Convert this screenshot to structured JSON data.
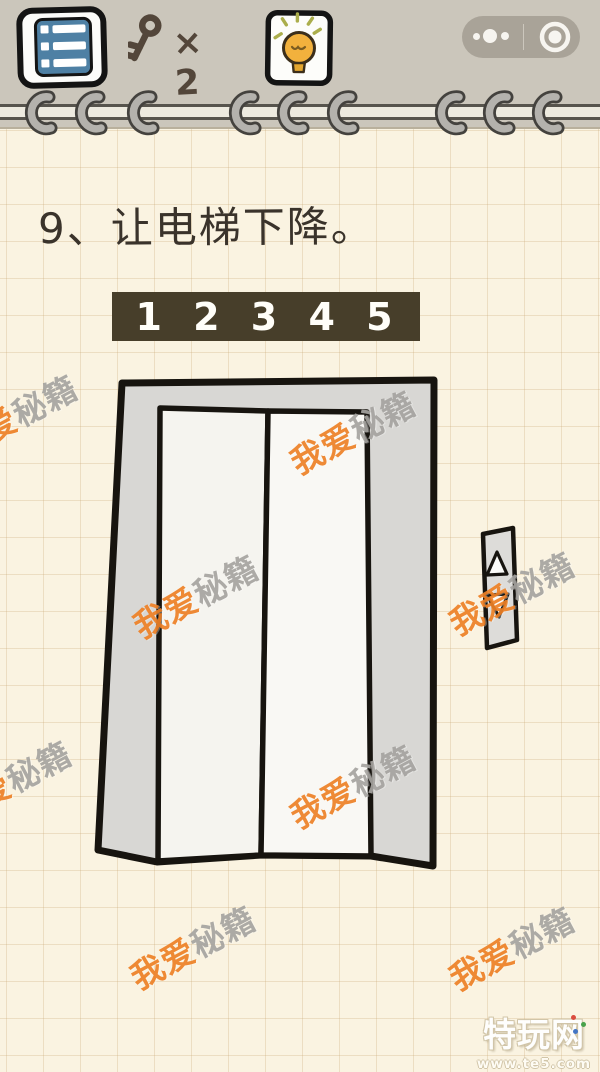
{
  "topbar": {
    "menu_button": {
      "icon_name": "list-menu-icon"
    },
    "key_counter": {
      "icon_name": "key-icon",
      "count_label": "× 2"
    },
    "hint_button": {
      "icon_name": "lightbulb-icon"
    },
    "capsule": {
      "more_icon": "three-dots-icon",
      "close_icon": "circle-button-icon"
    }
  },
  "puzzle": {
    "question_title": "9、让电梯下降。",
    "floor_indicator": {
      "floors": [
        "1",
        "2",
        "3",
        "4",
        "5"
      ],
      "display": "1 2 3 4 5"
    },
    "elevator": {
      "state": "doors-closed",
      "button_panel": {
        "up_icon": "triangle-up-icon",
        "down_icon": "triangle-down-icon"
      }
    }
  },
  "watermark": {
    "full_text": "我爱秘籍",
    "orange_part": "我爱",
    "gray_part": "秘籍"
  },
  "footer_logo": {
    "site_name": "特玩网",
    "site_url": "www.te5.com"
  },
  "colors": {
    "paper": "#faf3e1",
    "topbar_bg": "#cbc6bb",
    "indicator_bg": "#473e2a",
    "indicator_text": "#ffffff",
    "watermark_orange": "#ee8126",
    "watermark_gray": "#a6a4a0",
    "menu_blue": "#4e80a4",
    "ink_brown": "#53463a",
    "bulb_yellow": "#f2b13d",
    "frame_gray": "#d8d7d4",
    "door_white": "#f6f5f1"
  }
}
